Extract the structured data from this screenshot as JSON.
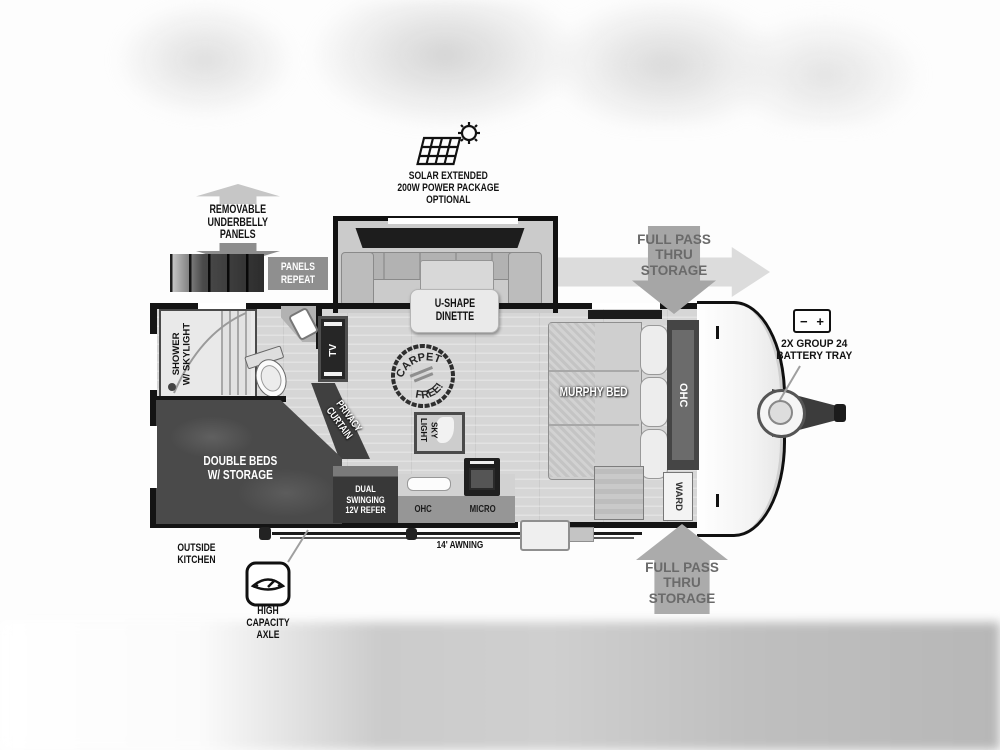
{
  "colors": {
    "wall": "#141414",
    "arrow_gray": "#a6a6a6",
    "arrow_light": "#dcdcdc",
    "arrow_text": "#6a6a6a",
    "dark_furniture": "#454545",
    "floor_gray": "#d6d6d6"
  },
  "labels": {
    "solar": "SOLAR EXTENDED\n200W POWER PACKAGE\nOPTIONAL",
    "underbelly": "REMOVABLE\nUNDERBELLY\nPANELS",
    "panels_repeat": "PANELS\nREPEAT",
    "pass_thru": "FULL PASS\nTHRU\nSTORAGE",
    "battery_minus": "−",
    "battery_plus": "+",
    "battery": "2X GROUP 24\nBATTERY TRAY",
    "dinette": "U-SHAPE\nDINETTE",
    "murphy_bed": "MURPHY BED",
    "ohc": "OHC",
    "ward": "WARD",
    "shower": "SHOWER\nW/ SKYLIGHT",
    "tv": "TV",
    "privacy_curtain": "PRIVACY\nCURTAIN",
    "double_beds": "DOUBLE BEDS\nW/ STORAGE",
    "refer": "DUAL SWINGING\n12V REFER",
    "micro": "MICRO",
    "skylight": "SKY\nLIGHT",
    "carpet_top": "CARPET",
    "carpet_bottom": "FREE!",
    "awning": "14' AWNING",
    "outside_kitchen": "OUTSIDE\nKITCHEN",
    "axle": "HIGH CAPACITY\nAXLE"
  }
}
